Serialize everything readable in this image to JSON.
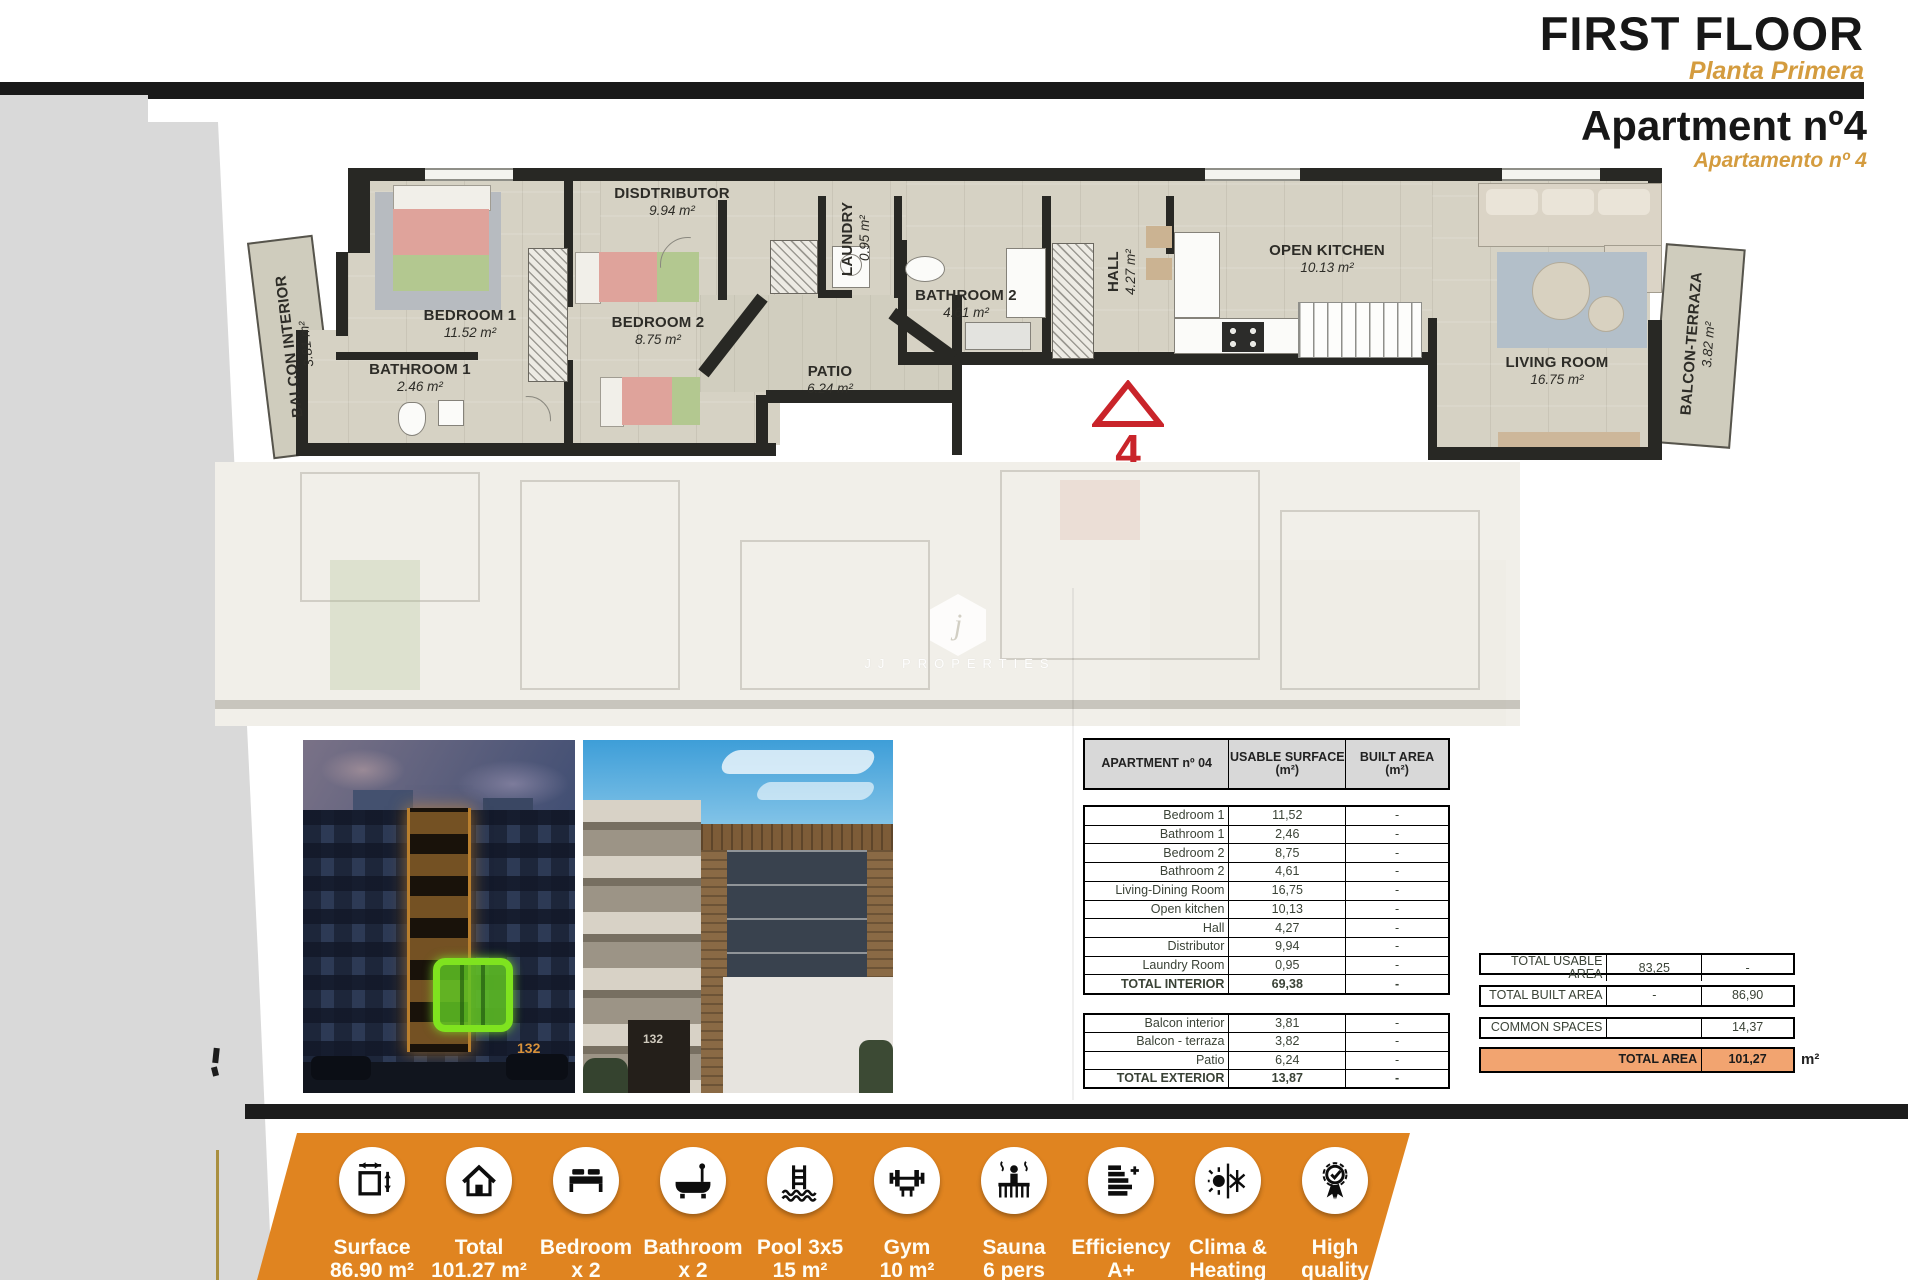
{
  "header": {
    "title": "FIRST FLOOR",
    "subtitle": "Planta Primera",
    "apartment_title": "Apartment nº4",
    "apartment_subtitle": "Apartamento nº 4"
  },
  "floor_plan": {
    "marker_number": "4",
    "watermark_letter": "j",
    "watermark_text": "JJ PROPERTIES",
    "rooms": [
      {
        "id": "bedroom1",
        "name": "BEDROOM 1",
        "area": "11.52 m²"
      },
      {
        "id": "bathroom1",
        "name": "BATHROOM 1",
        "area": "2.46 m²"
      },
      {
        "id": "bedroom2",
        "name": "BEDROOM 2",
        "area": "8.75 m²"
      },
      {
        "id": "distributor",
        "name": "DISDTRIBUTOR",
        "area": "9.94 m²"
      },
      {
        "id": "laundry",
        "name": "LAUNDRY",
        "area": "0.95 m²"
      },
      {
        "id": "patio",
        "name": "PATIO",
        "area": "6.24 m²"
      },
      {
        "id": "bathroom2",
        "name": "BATHROOM 2",
        "area": "4.61 m²"
      },
      {
        "id": "hall",
        "name": "HALL",
        "area": "4.27 m²"
      },
      {
        "id": "kitchen",
        "name": "OPEN KITCHEN",
        "area": "10.13 m²"
      },
      {
        "id": "living",
        "name": "LIVING ROOM",
        "area": "16.75 m²"
      },
      {
        "id": "balcon_interior",
        "name": "BALCON INTERIOR",
        "area": "3.81 m²"
      },
      {
        "id": "balcon_terraza",
        "name": "BALCON-TERRAZA",
        "area": "3.82 m²"
      }
    ]
  },
  "photos": {
    "building_number_night": "132",
    "building_number_day": "132"
  },
  "area_table": {
    "col1_header": "APARTMENT nº 04",
    "col2_header_line1": "USABLE SURFACE",
    "col2_header_line2": "(m²)",
    "col3_header_line1": "BUILT AREA",
    "col3_header_line2": "(m²)",
    "interior_rows": [
      {
        "label": "Bedroom 1",
        "usable": "11,52",
        "built": "-"
      },
      {
        "label": "Bathroom 1",
        "usable": "2,46",
        "built": "-"
      },
      {
        "label": "Bedroom 2",
        "usable": "8,75",
        "built": "-"
      },
      {
        "label": "Bathroom 2",
        "usable": "4,61",
        "built": "-"
      },
      {
        "label": "Living-Dining Room",
        "usable": "16,75",
        "built": "-"
      },
      {
        "label": "Open kitchen",
        "usable": "10,13",
        "built": "-"
      },
      {
        "label": "Hall",
        "usable": "4,27",
        "built": "-"
      },
      {
        "label": "Distributor",
        "usable": "9,94",
        "built": "-"
      },
      {
        "label": "Laundry Room",
        "usable": "0,95",
        "built": "-"
      },
      {
        "label": "TOTAL INTERIOR",
        "usable": "69,38",
        "built": "-",
        "total": true
      }
    ],
    "exterior_rows": [
      {
        "label": "Balcon interior",
        "usable": "3,81",
        "built": "-"
      },
      {
        "label": "Balcon - terraza",
        "usable": "3,82",
        "built": "-"
      },
      {
        "label": "Patio",
        "usable": "6,24",
        "built": "-"
      },
      {
        "label": "TOTAL EXTERIOR",
        "usable": "13,87",
        "built": "-",
        "total": true
      }
    ]
  },
  "summary": {
    "rows": [
      {
        "label": "TOTAL USABLE AREA",
        "usable": "83,25",
        "built": "-"
      },
      {
        "label": "TOTAL BUILT AREA",
        "usable": "-",
        "built": "86,90"
      },
      {
        "label": "COMMON SPACES",
        "usable": "",
        "built": "14,37"
      },
      {
        "label": "TOTAL AREA",
        "value": "101,27",
        "highlight": true
      }
    ],
    "unit": "m²"
  },
  "features": [
    {
      "id": "surface",
      "line1": "Surface",
      "line2": "86.90 m²"
    },
    {
      "id": "total",
      "line1": "Total",
      "line2": "101.27 m²"
    },
    {
      "id": "bedroom",
      "line1": "Bedroom",
      "line2": "x 2"
    },
    {
      "id": "bathroom",
      "line1": "Bathroom",
      "line2": "x 2"
    },
    {
      "id": "pool",
      "line1": "Pool 3x5",
      "line2": "15 m²"
    },
    {
      "id": "gym",
      "line1": "Gym",
      "line2": "10 m²"
    },
    {
      "id": "sauna",
      "line1": "Sauna",
      "line2": "6 pers"
    },
    {
      "id": "efficiency",
      "line1": "Efficiency",
      "line2": "A+"
    },
    {
      "id": "climate",
      "line1": "Clima &",
      "line2": "Heating"
    },
    {
      "id": "quality",
      "line1": "High",
      "line2": "quality"
    }
  ],
  "colors": {
    "accent_orange": "#e08420",
    "subtitle_orange": "#d49c3f",
    "marker_red": "#c9242a",
    "total_row_orange": "#f2a470"
  }
}
